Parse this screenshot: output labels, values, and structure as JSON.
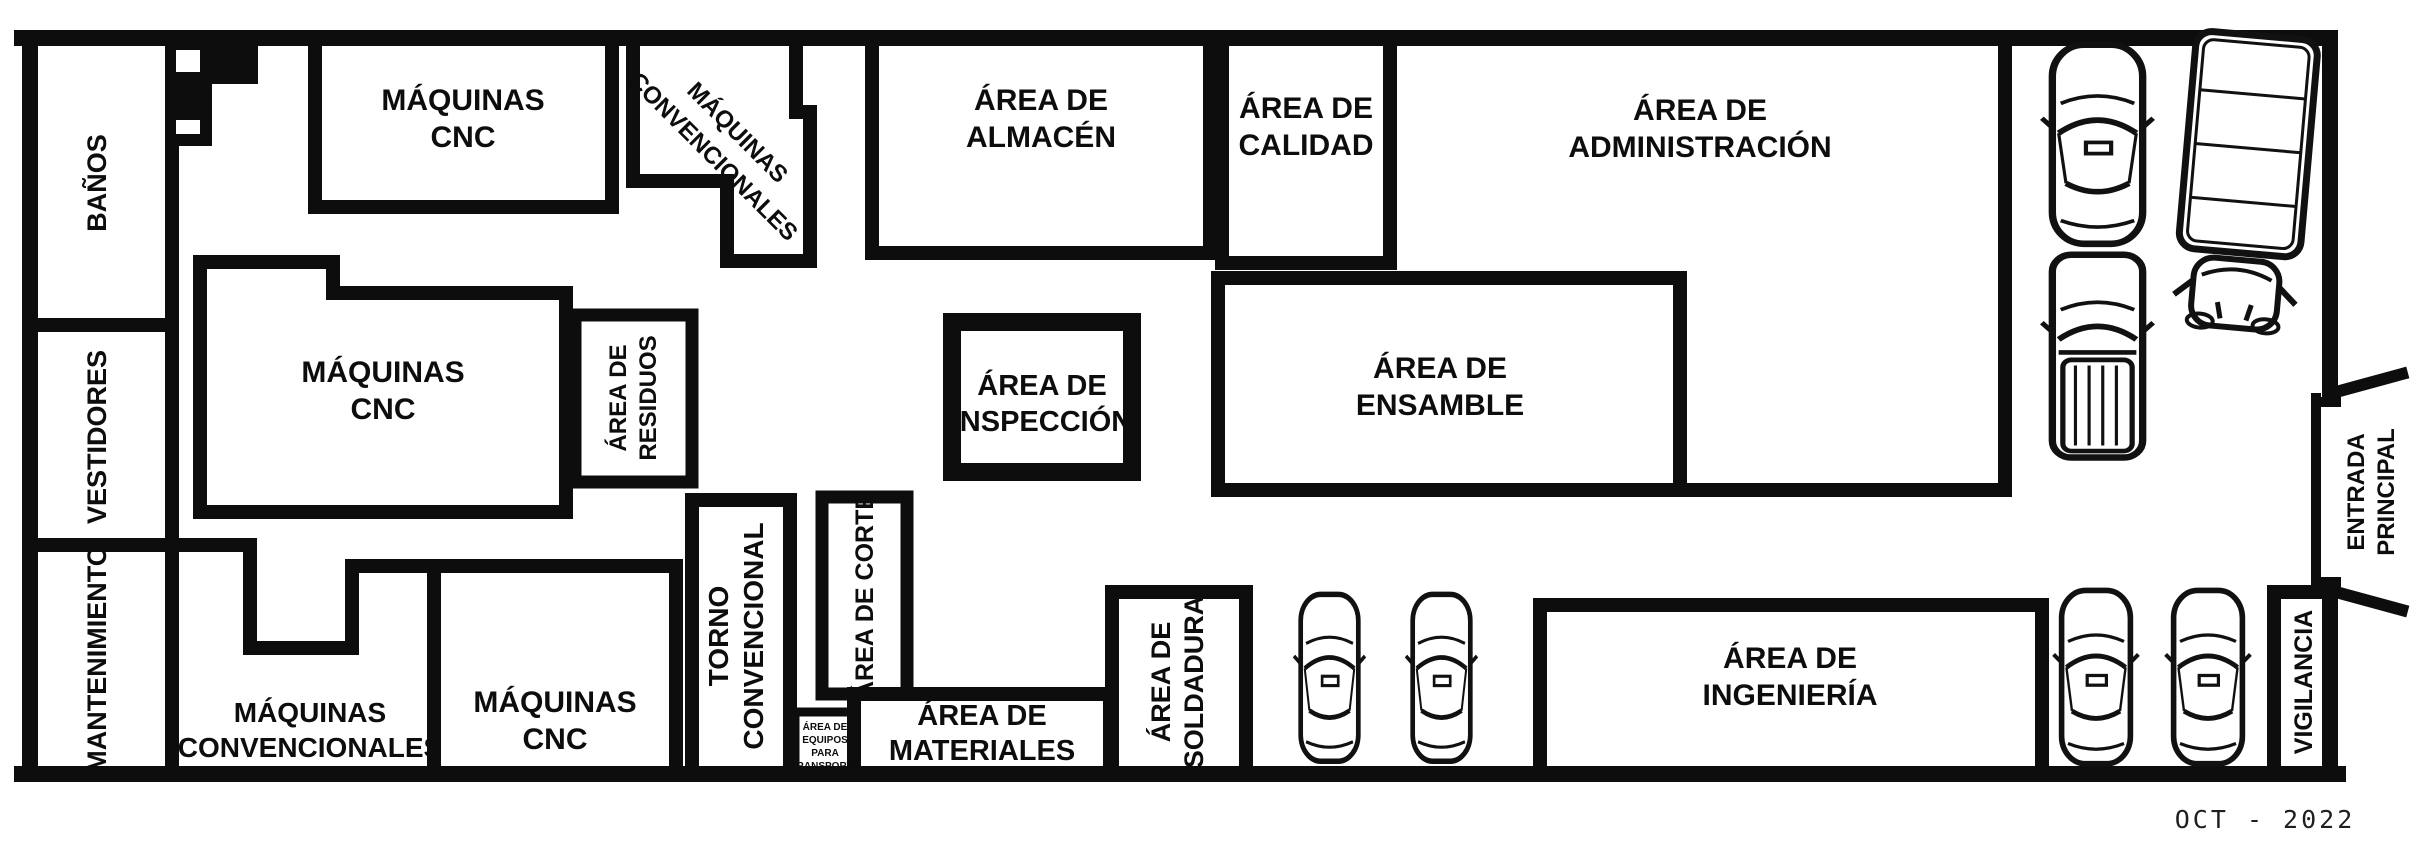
{
  "rooms": {
    "banos": {
      "label": "BAÑOS"
    },
    "vestidores": {
      "label": "VESTIDORES"
    },
    "mantenimiento": {
      "label": "MANTENIMIENTO"
    },
    "maquinas_cnc_top": {
      "lines": [
        "MÁQUINAS",
        "CNC"
      ]
    },
    "maquinas_convencionales_top": {
      "lines": [
        "MÁQUINAS",
        "CONVENCIONALES"
      ]
    },
    "area_almacen": {
      "lines": [
        "ÁREA DE",
        "ALMACÉN"
      ]
    },
    "area_calidad": {
      "lines": [
        "ÁREA DE",
        "CALIDAD"
      ]
    },
    "area_administracion": {
      "lines": [
        "ÁREA DE",
        "ADMINISTRACIÓN"
      ]
    },
    "maquinas_cnc_mid": {
      "lines": [
        "MÁQUINAS",
        "CNC"
      ]
    },
    "area_residuos": {
      "lines": [
        "ÁREA DE",
        "RESIDUOS"
      ]
    },
    "area_inspeccion": {
      "lines": [
        "ÁREA DE",
        "INSPECCIÓN"
      ]
    },
    "area_ensamble": {
      "lines": [
        "ÁREA DE",
        "ENSAMBLE"
      ]
    },
    "maquinas_convencionales_bottom": {
      "lines": [
        "MÁQUINAS",
        "CONVENCIONALES"
      ]
    },
    "maquinas_cnc_bottom": {
      "lines": [
        "MÁQUINAS",
        "CNC"
      ]
    },
    "torno_convencional": {
      "lines": [
        "TORNO",
        "CONVENCIONAL"
      ]
    },
    "area_corte": {
      "label": "ÁREA DE CORTE"
    },
    "area_equipos_transporte": {
      "lines": [
        "ÁREA DE",
        "EQUIPOS",
        "PARA",
        "TRANSPORTE"
      ]
    },
    "area_materiales": {
      "lines": [
        "ÁREA DE",
        "MATERIALES"
      ]
    },
    "area_soldadura": {
      "lines": [
        "ÁREA DE",
        "SOLDADURA"
      ]
    },
    "area_ingenieria": {
      "lines": [
        "ÁREA DE",
        "INGENIERÍA"
      ]
    },
    "vigilancia": {
      "label": "VIGILANCIA"
    },
    "entrada_principal": {
      "lines": [
        "ENTRADA",
        "PRINCIPAL"
      ]
    }
  },
  "annotations": {
    "date": "OCT - 2022"
  },
  "vehicles": {
    "suv_top": "suv-top-view",
    "pickup_top": "pickup-truck-top-view",
    "box_truck": "box-truck-top-view",
    "parked_cars": [
      "car-top-view",
      "car-top-view",
      "car-top-view",
      "car-top-view"
    ]
  },
  "colors": {
    "wall": "#0d0d0d",
    "floor": "#ffffff"
  }
}
